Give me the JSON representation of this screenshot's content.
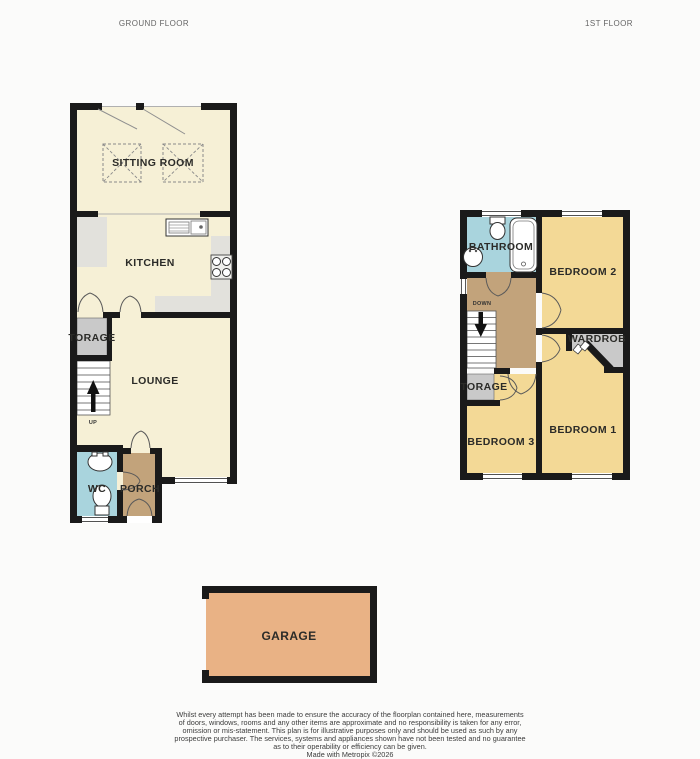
{
  "header": {
    "ground_floor_title": "GROUND FLOOR",
    "first_floor_title": "1ST FLOOR"
  },
  "ground_floor": {
    "sitting_room": "SITTING ROOM",
    "kitchen": "KITCHEN",
    "storage": "TORAGE",
    "lounge": "LOUNGE",
    "wc": "WC",
    "porch": "PORCH",
    "stairs_label": "UP"
  },
  "first_floor": {
    "bathroom": "BATHROOM",
    "bedroom2": "BEDROOM 2",
    "wardrobe": "WARDROB",
    "storage": "TORAGE",
    "bedroom3": "BEDROOM 3",
    "bedroom1": "BEDROOM 1",
    "stairs_label": "DOWN"
  },
  "garage": {
    "label": "GARAGE"
  },
  "colors": {
    "wall": "#1a1a1a",
    "cream": "#f6f0d6",
    "bedroom_yellow": "#f3d996",
    "bath_blue": "#a9d4dd",
    "landing_tan": "#c2a37b",
    "storage_gray": "#c9c9c9",
    "counter_gray": "#e2e1dc",
    "garage_orange": "#e9b285",
    "stairs_white": "#ffffff"
  },
  "disclaimer": {
    "line1": "Whilst every attempt has been made to ensure the accuracy of the floorplan contained here, measurements",
    "line2": "of doors, windows, rooms and any other items are approximate and no responsibility is taken for any error,",
    "line3": "omission or mis-statement. This plan is for illustrative purposes only and should be used as such by any",
    "line4": "prospective purchaser. The services, systems and appliances shown have not been tested and no guarantee",
    "line5": "as to their operability or efficiency can be given.",
    "credit": "Made with Metropix ©2026"
  }
}
